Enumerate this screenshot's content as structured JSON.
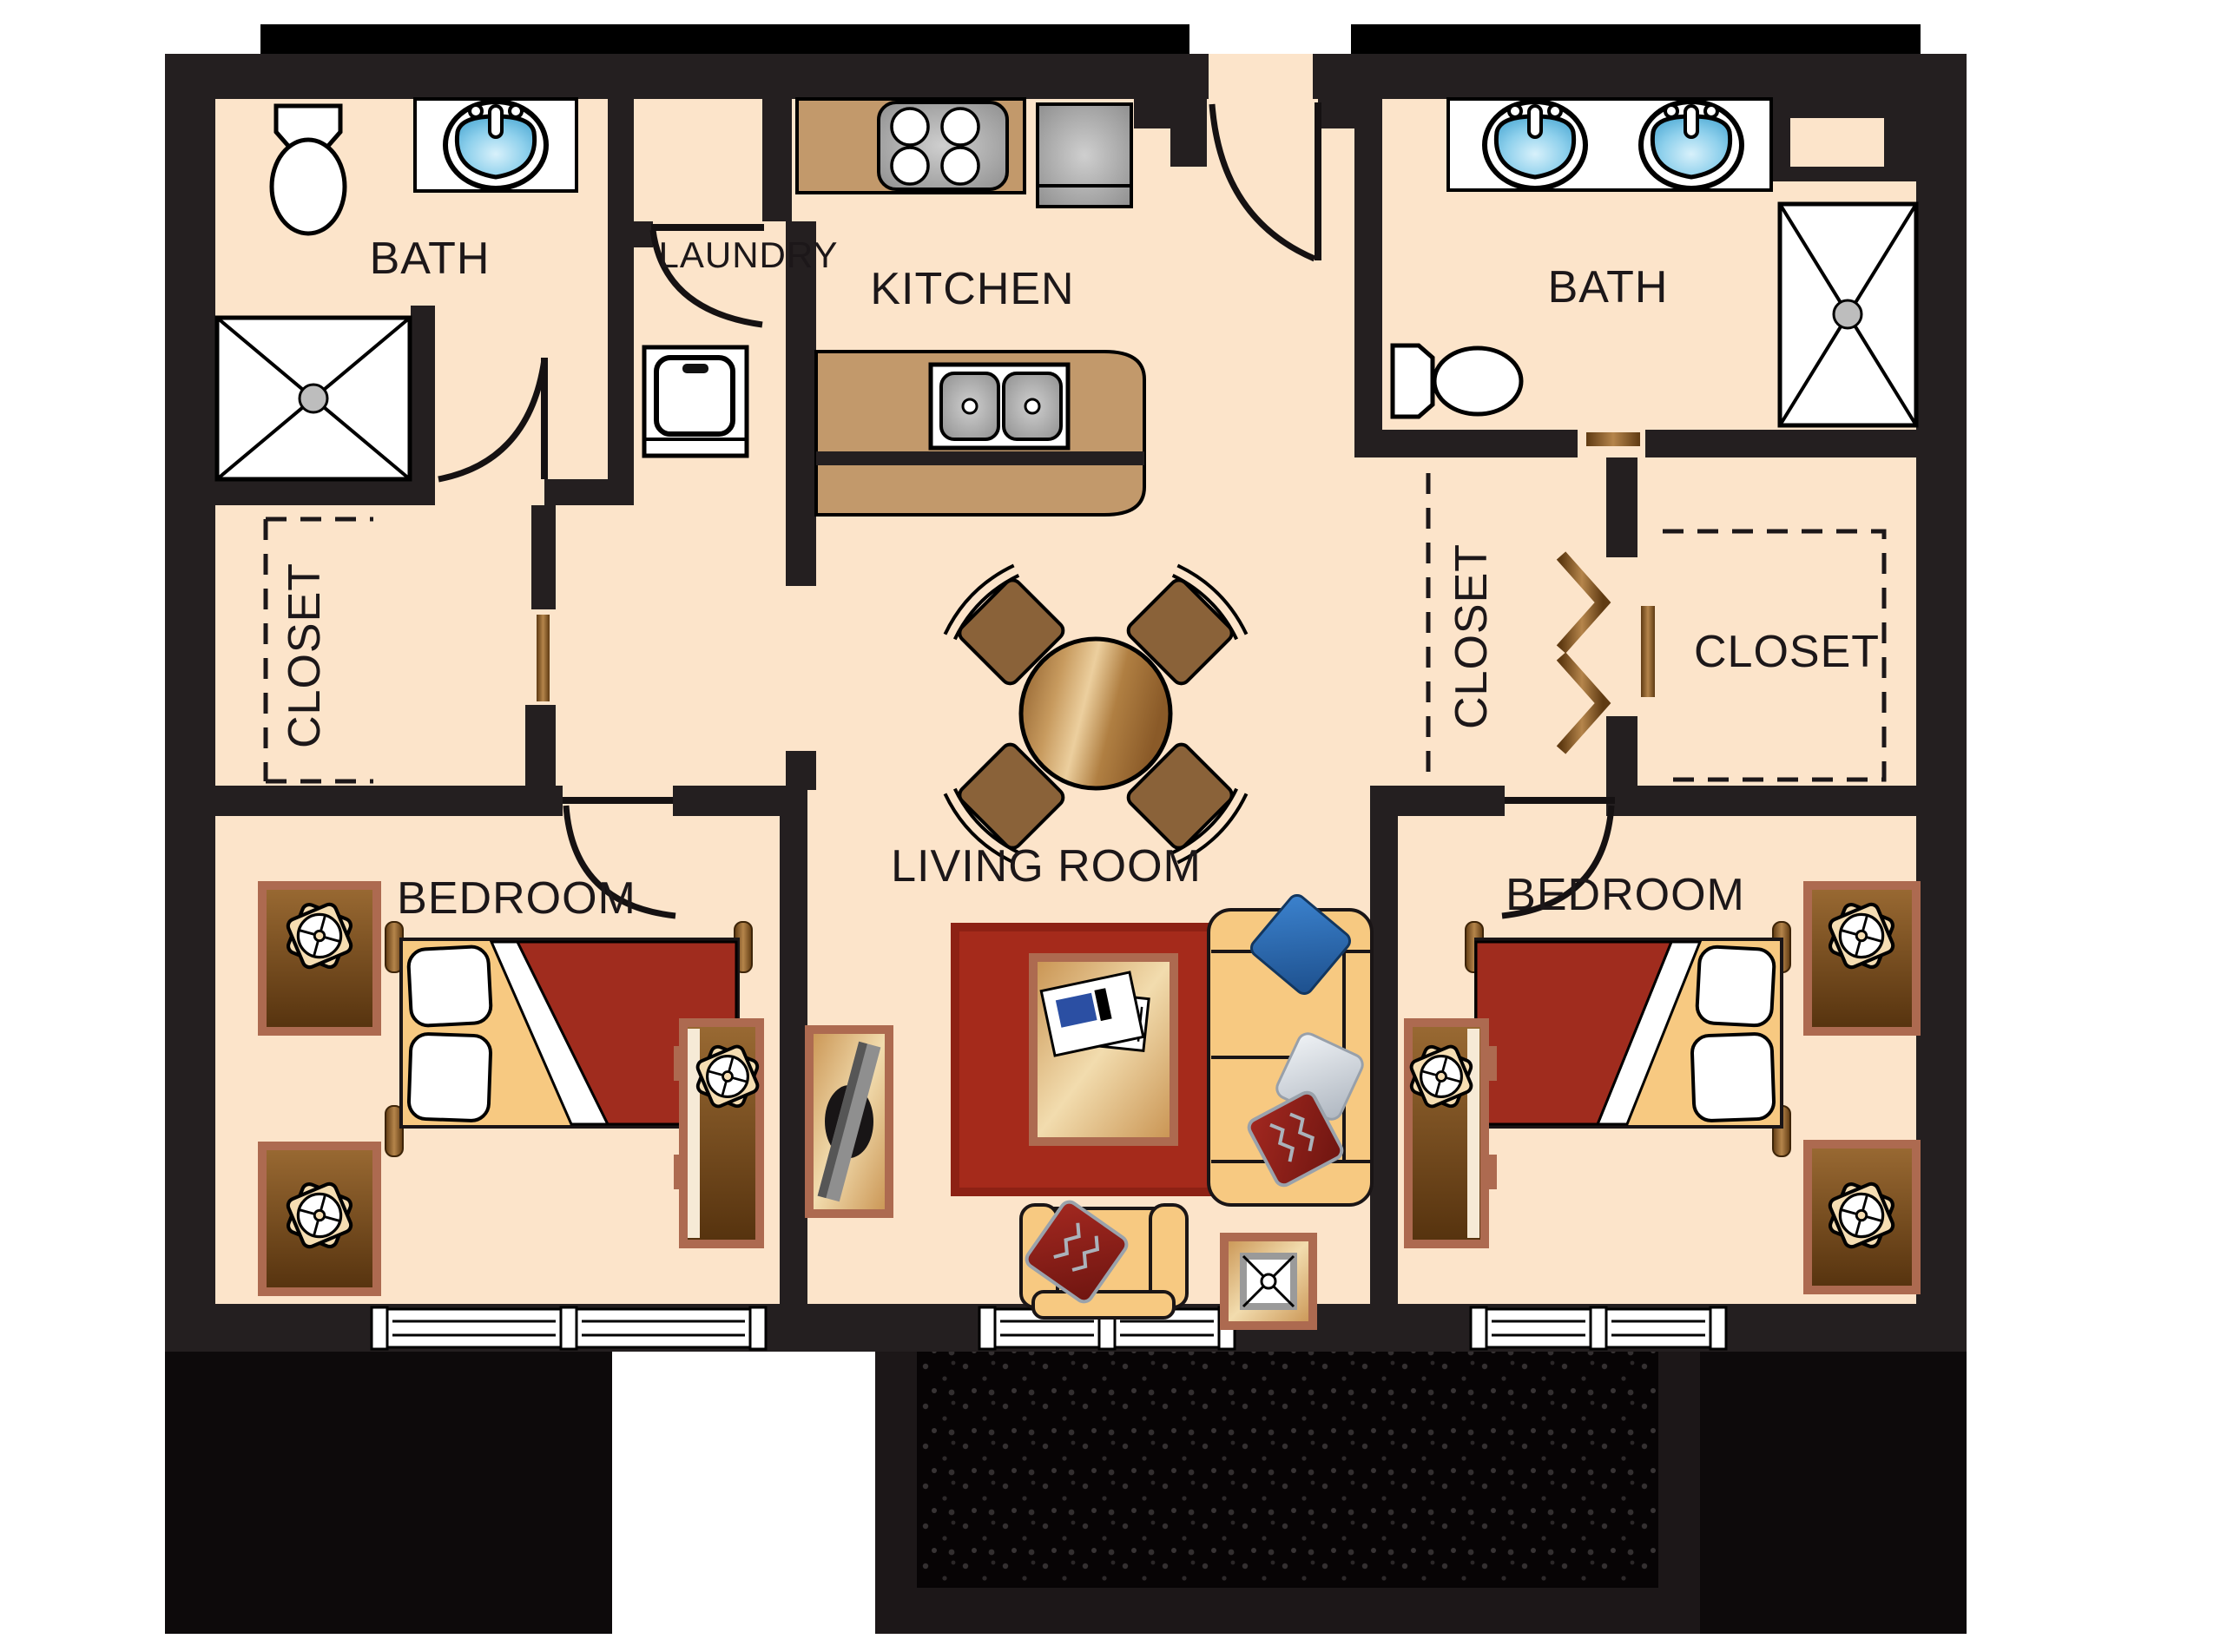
{
  "title": "Two Bedroom / Two Bath Apartment Floor Plan",
  "rooms": {
    "bath_left": {
      "label": "BATH",
      "fixtures": [
        "toilet",
        "vanity-sink",
        "shower"
      ]
    },
    "laundry": {
      "label": "LAUNDRY",
      "fixtures": [
        "washer"
      ]
    },
    "kitchen": {
      "label": "KITCHEN",
      "fixtures": [
        "stove",
        "refrigerator",
        "island-double-sink"
      ]
    },
    "bath_right": {
      "label": "BATH",
      "fixtures": [
        "double-vanity-sinks",
        "toilet",
        "shower",
        "linen-niche"
      ]
    },
    "closet_left": {
      "label": "CLOSET",
      "fixtures": [
        "hanging-rod"
      ]
    },
    "closet_mid": {
      "label": "CLOSET",
      "fixtures": [
        "bifold-doors"
      ]
    },
    "closet_right": {
      "label": "CLOSET",
      "fixtures": [
        "hanging-rod",
        "dashed-shelving"
      ]
    },
    "living_room": {
      "label": "LIVING ROOM",
      "fixtures": [
        "dining-table",
        "dining-chairs",
        "rug",
        "coffee-table",
        "magazines",
        "sofa",
        "throw-pillows",
        "armchair",
        "end-table-lamp",
        "tv-console",
        "tv"
      ]
    },
    "bedroom_left": {
      "label": "BEDROOM",
      "fixtures": [
        "bed",
        "pillows",
        "nightstand-lamps",
        "dresser",
        "windows"
      ]
    },
    "bedroom_right": {
      "label": "BEDROOM",
      "fixtures": [
        "bed",
        "pillows",
        "nightstand-lamps",
        "dresser",
        "windows"
      ]
    }
  },
  "outdoor": {
    "patio": "balcony-patio"
  },
  "colors": {
    "floor": "#fce4ca",
    "wall": "#241f20",
    "outline": "#000000",
    "counter": "#c2996b",
    "wood": "#9a6a33",
    "wood_dark": "#55320e",
    "post_light": "#b5854b",
    "rug_red": "#a52a1b",
    "blanket_red": "#a02c1e",
    "sofa": "#f7c981",
    "gold": "#e9c98f",
    "mauve": "#ad6a50",
    "sink_blue": "#6fc3e8",
    "steel": "#a9a9a9",
    "pillow_blue": "#2a6cb5",
    "pillow_red": "#8e211b",
    "pillow_silver": "#ccd3da",
    "white": "#ffffff",
    "patio": "#070405"
  }
}
